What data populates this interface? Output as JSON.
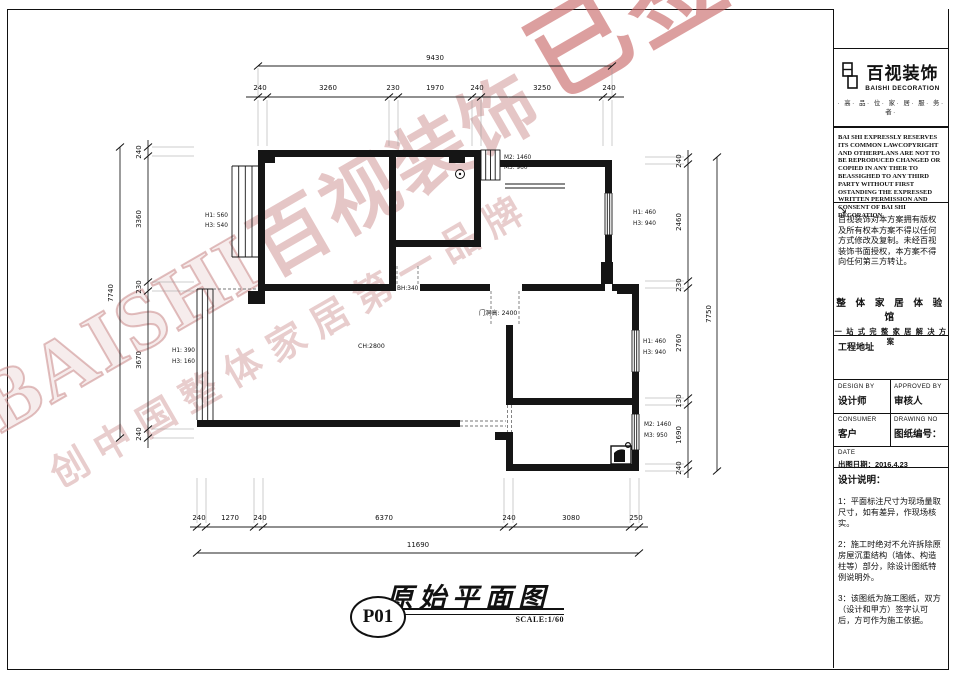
{
  "watermark": {
    "baishi": "BAISHI",
    "brand_cn": "百视装饰",
    "signed": "已签约",
    "slogan": "创中国整体家居第一品牌"
  },
  "plan": {
    "dims": {
      "top": {
        "total": "9430",
        "segments": [
          "240",
          "3260",
          "230",
          "1970",
          "240",
          "3250",
          "240"
        ]
      },
      "left": {
        "total": "7740",
        "segments": [
          "240",
          "3360",
          "230",
          "3670",
          "240"
        ]
      },
      "right": {
        "total": "7750",
        "segments": [
          "240",
          "2460",
          "230",
          "2760",
          "130",
          "1690",
          "240"
        ]
      },
      "bottom": {
        "total": "11690",
        "segments": [
          "240",
          "1270",
          "240",
          "6370",
          "240",
          "3080",
          "250"
        ]
      }
    },
    "labels": {
      "m2_top": "M2: 1460",
      "m3_top": "M3: 960",
      "h1_left_up": "H1: 560",
      "h3_left_up": "H3: 540",
      "h1_right_up": "H1: 460",
      "h3_right_up": "H3: 940",
      "bh": "BH:340",
      "door_height": "门洞高: 2400",
      "ch": "CH:2800",
      "h1_left_low": "H1: 390",
      "h3_left_low": "H3: 160",
      "h1_right_mid": "H1: 460",
      "h3_right_mid": "H3: 940",
      "m2_right": "M2: 1460",
      "m3_right": "M3: 950"
    }
  },
  "title_block": {
    "sheet_no": "P01",
    "title": "原始平面图",
    "scale": "SCALE:1/60"
  },
  "panel": {
    "logo": {
      "cn": "百视装饰",
      "en": "BAISHI DECORATION",
      "slogan": "· 高· 品· 位· 家· 居· 服· 务· 者·"
    },
    "copyright_en": "BAI SHI EXPRESSLY RESERVES ITS COMMON LAWCOPYRIGHT AND OTHERPLANS ARE NOT TO BE REPRODUCED CHANGED OR COPIED IN ANY THER TO BEASSIGHED TO ANY THIRD PARTY WITHOUT FIRST OSTANDING THE EXPRESSED WRITTEN PERMISSION AND CONSENT OF BAI SHI DECORATION",
    "arrow": "↘",
    "copyright_cn": "百视装饰对本方案拥有版权及所有权本方案不得以任何方式修改及复制。未经百视装饰书面授权，本方案不得向任何第三方转让。",
    "experience_hall": "整 体 家 居 体 验 馆",
    "one_stop": "一 站 式 完 整 家 居 解 决 方 案",
    "project_address": "工程地址",
    "design_by_en": "DESIGN BY",
    "design_by_cn": "设计师",
    "approved_by_en": "APPROVED BY",
    "approved_by_cn": "审核人",
    "consumer_en": "CONSUMER",
    "consumer_cn": "客户",
    "drawing_no_en": "DRAWING NO",
    "drawing_no_cn": "图纸编号：",
    "date_en": "DATE",
    "date_cn": "出图日期：2016.4.23",
    "notes_title": "设计说明：",
    "notes": [
      "1：平面标注尺寸为现场量取尺寸，如有差异，作现场核实。",
      "2：施工时绝对不允许拆除原房屋沉重结构（墙体、构造柱等）部分，除设计图纸特例说明外。",
      "3：该图纸为施工图纸，双方（设计和甲方）签字认可后，方可作为施工依据。"
    ]
  }
}
